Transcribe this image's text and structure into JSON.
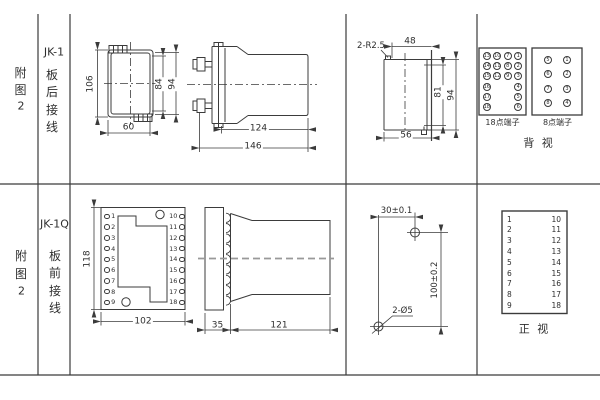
{
  "colors": {
    "line": "#3b3b3b",
    "text": "#2e2e2e",
    "background": "#ffffff",
    "centerline_gray": "#999999"
  },
  "figure1": {
    "row_label": [
      "附",
      "图",
      "2"
    ],
    "model": "JK-1",
    "wiring": [
      "板",
      "后",
      "接",
      "线"
    ],
    "rear_view_dims": {
      "height_outer": "106",
      "height_inner": "84",
      "height_mount": "94",
      "width": "60"
    },
    "side_view_dims": {
      "body_length": "124",
      "total_length": "146"
    },
    "cutout": {
      "radius_note": "2-R2.5",
      "width_top": "48",
      "height_inner": "81",
      "height_outer": "94",
      "width_bottom": "56"
    },
    "terminal18": {
      "label": "18点端子",
      "grid": [
        [
          "13",
          "10",
          "7",
          "1"
        ],
        [
          "14",
          "11",
          "8",
          "2"
        ],
        [
          "15",
          "12",
          "9",
          "3"
        ],
        [
          "16",
          "",
          "",
          "4"
        ],
        [
          "17",
          "",
          "",
          "5"
        ],
        [
          "18",
          "",
          "",
          "6"
        ]
      ]
    },
    "terminal8": {
      "label": "8点端子",
      "grid": [
        [
          "5",
          "1"
        ],
        [
          "6",
          "2"
        ],
        [
          "7",
          "3"
        ],
        [
          "8",
          "4"
        ]
      ]
    },
    "view_label": "背 视"
  },
  "figure2": {
    "row_label": [
      "附",
      "图",
      "2"
    ],
    "model": "JK-1Q",
    "wiring": [
      "板",
      "前",
      "接",
      "线"
    ],
    "front_view": {
      "dims": {
        "height": "118",
        "width": "102"
      },
      "left_terminals": [
        "1",
        "2",
        "3",
        "4",
        "5",
        "6",
        "7",
        "8",
        "9"
      ],
      "right_terminals": [
        "10",
        "11",
        "12",
        "13",
        "14",
        "15",
        "16",
        "17",
        "18"
      ]
    },
    "side_view_dims": {
      "flange": "35",
      "body": "121"
    },
    "drill": {
      "hole_spacing_x": "30±0.1",
      "hole_spacing_y": "100±0.2",
      "hole_note": "2-Ø5"
    },
    "terminal_table": {
      "left": [
        "1",
        "2",
        "3",
        "4",
        "5",
        "6",
        "7",
        "8",
        "9"
      ],
      "right": [
        "10",
        "11",
        "12",
        "13",
        "14",
        "15",
        "16",
        "17",
        "18"
      ],
      "label": "正 视"
    }
  }
}
